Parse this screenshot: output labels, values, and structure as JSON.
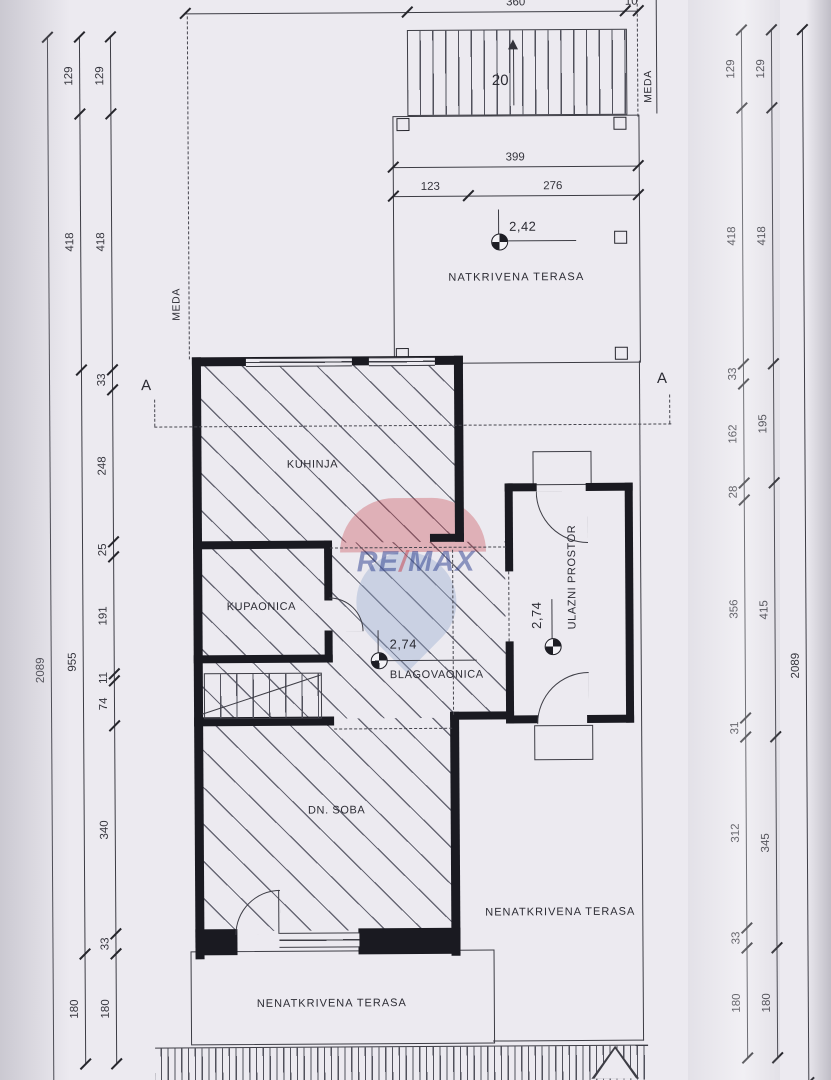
{
  "labels": {
    "natkrivena_terasa": "NATKRIVENA TERASA",
    "kuhinja": "KUHINJA",
    "kupaonica": "KUPAONICA",
    "blagovaonica": "BLAGOVAONICA",
    "ulazni_prostor": "ULAZNI PROSTOR",
    "dn_soba": "DN. SOBA",
    "nenatkrivena_terasa_desno": "NENATKRIVENA TERASA",
    "nenatkrivena_terasa_dolje": "NENATKRIVENA TERASA",
    "meda_lijevo": "MEDA",
    "meda_desno": "MEDA",
    "section_a_left": "A",
    "section_a_right": "A",
    "stair_steps": "20"
  },
  "levels": {
    "terasa": "2,42",
    "blagovaonica": "2,74",
    "ulaz": "2,74"
  },
  "watermark": {
    "left": "RE",
    "slash": "/",
    "right": "MAX"
  },
  "colors": {
    "paper": "#eceaf0",
    "line": "#3d3d45",
    "wall": "#1a1a21",
    "remax_red": "#c8404a",
    "remax_blue": "#2c3f8f",
    "balloon_blue": "#93a7cd"
  },
  "dim_chains": [
    {
      "id": "left-inner",
      "orient": "v",
      "x": 113,
      "segments": [
        {
          "label": "129",
          "from": 35,
          "to": 112
        },
        {
          "label": "418",
          "from": 112,
          "to": 368
        },
        {
          "label": "33",
          "from": 368,
          "to": 388
        },
        {
          "label": "248",
          "from": 388,
          "to": 540
        },
        {
          "label": "25",
          "from": 540,
          "to": 555
        },
        {
          "label": "191",
          "from": 555,
          "to": 672
        },
        {
          "label": "11",
          "from": 672,
          "to": 679
        },
        {
          "label": "74",
          "from": 679,
          "to": 724
        },
        {
          "label": "340",
          "from": 724,
          "to": 932
        },
        {
          "label": "33",
          "from": 932,
          "to": 952
        },
        {
          "label": "180",
          "from": 952,
          "to": 1062
        }
      ]
    },
    {
      "id": "left-middle",
      "orient": "v",
      "x": 82,
      "segments": [
        {
          "label": "129",
          "from": 35,
          "to": 112
        },
        {
          "label": "418",
          "from": 112,
          "to": 368
        },
        {
          "label": "955",
          "from": 368,
          "to": 952
        },
        {
          "label": "180",
          "from": 952,
          "to": 1062
        }
      ]
    },
    {
      "id": "left-outer",
      "orient": "v",
      "x": 50,
      "segments": [
        {
          "label": "2089",
          "from": 35,
          "to": 1085,
          "label_at": 668
        }
      ]
    },
    {
      "id": "right-inner",
      "orient": "v",
      "x": 744,
      "segments": [
        {
          "label": "129",
          "from": 32,
          "to": 110
        },
        {
          "label": "418",
          "from": 110,
          "to": 366
        },
        {
          "label": "33",
          "from": 366,
          "to": 386
        },
        {
          "label": "162",
          "from": 386,
          "to": 485
        },
        {
          "label": "28",
          "from": 485,
          "to": 502
        },
        {
          "label": "356",
          "from": 502,
          "to": 720
        },
        {
          "label": "31",
          "from": 720,
          "to": 739
        },
        {
          "label": "312",
          "from": 739,
          "to": 930
        },
        {
          "label": "33",
          "from": 930,
          "to": 950
        },
        {
          "label": "180",
          "from": 950,
          "to": 1060
        }
      ]
    },
    {
      "id": "right-middle",
      "orient": "v",
      "x": 774,
      "segments": [
        {
          "label": "129",
          "from": 32,
          "to": 110
        },
        {
          "label": "418",
          "from": 110,
          "to": 366
        },
        {
          "label": "195",
          "from": 366,
          "to": 485
        },
        {
          "label": "415",
          "from": 485,
          "to": 739
        },
        {
          "label": "345",
          "from": 739,
          "to": 950
        },
        {
          "label": "180",
          "from": 950,
          "to": 1060
        }
      ]
    },
    {
      "id": "right-outer",
      "orient": "v",
      "x": 805,
      "segments": [
        {
          "label": "2089",
          "from": 32,
          "to": 1085,
          "label_at": 668
        }
      ]
    },
    {
      "id": "top-stairs",
      "orient": "h",
      "y": 12,
      "segments": [
        {
          "label": "",
          "from": 188,
          "to": 410
        },
        {
          "label": "360",
          "from": 410,
          "to": 628
        },
        {
          "label": "10",
          "from": 628,
          "to": 641
        }
      ]
    },
    {
      "id": "terrace-width",
      "orient": "h",
      "y": 167,
      "segments": [
        {
          "label": "399",
          "from": 395,
          "to": 640
        }
      ]
    },
    {
      "id": "terrace-split",
      "orient": "h",
      "y": 196,
      "segments": [
        {
          "label": "123",
          "from": 395,
          "to": 470
        },
        {
          "label": "276",
          "from": 470,
          "to": 640
        }
      ]
    }
  ]
}
